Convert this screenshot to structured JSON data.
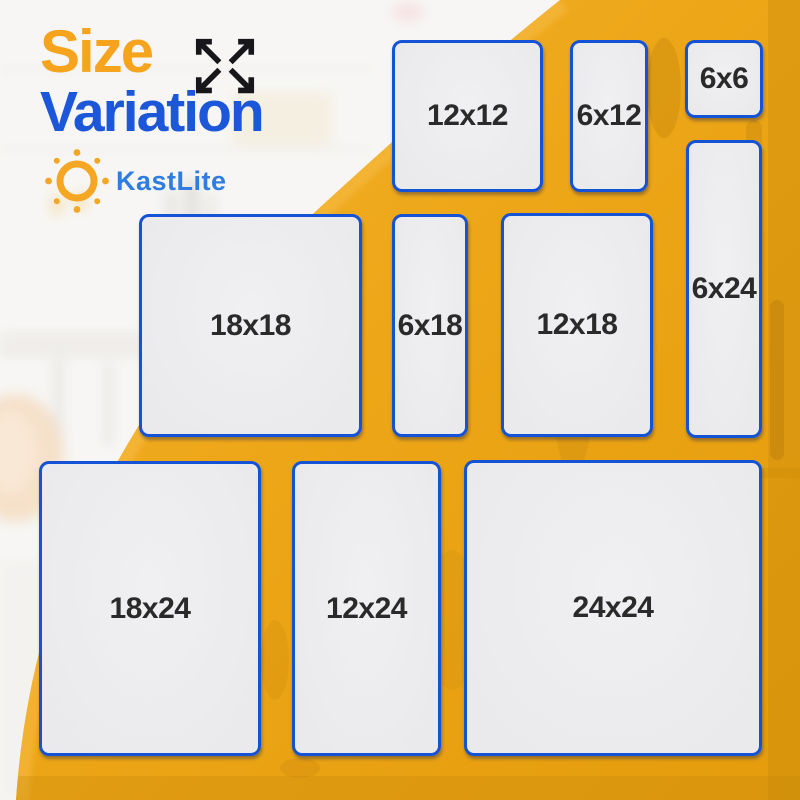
{
  "header": {
    "title_line1": "Size",
    "title_line2": "Variation"
  },
  "brand": {
    "name": "KastLite"
  },
  "panels": [
    {
      "label": "12x12",
      "width_in": 12,
      "height_in": 12
    },
    {
      "label": "6x12",
      "width_in": 6,
      "height_in": 12
    },
    {
      "label": "6x6",
      "width_in": 6,
      "height_in": 6
    },
    {
      "label": "6x24",
      "width_in": 6,
      "height_in": 24
    },
    {
      "label": "18x18",
      "width_in": 18,
      "height_in": 18
    },
    {
      "label": "6x18",
      "width_in": 6,
      "height_in": 18
    },
    {
      "label": "12x18",
      "width_in": 12,
      "height_in": 18
    },
    {
      "label": "18x24",
      "width_in": 18,
      "height_in": 24
    },
    {
      "label": "12x24",
      "width_in": 12,
      "height_in": 24
    },
    {
      "label": "24x24",
      "width_in": 24,
      "height_in": 24
    }
  ],
  "icons": {
    "expand": "expand-arrows-icon",
    "sun": "sun-icon"
  },
  "colors": {
    "title-orange": "#F6A41E",
    "title-blue": "#1C57DA",
    "brand-blue": "#2F7DE2",
    "background-yellow": "#EDA617",
    "background-yellow-light": "#F5B433",
    "background-yellow-dark": "#E49C0C",
    "panel-fill": "#EAEAEC",
    "panel-border": "#1553D6",
    "label-color": "#2A2A2A",
    "sun-orange": "#F5A623"
  }
}
